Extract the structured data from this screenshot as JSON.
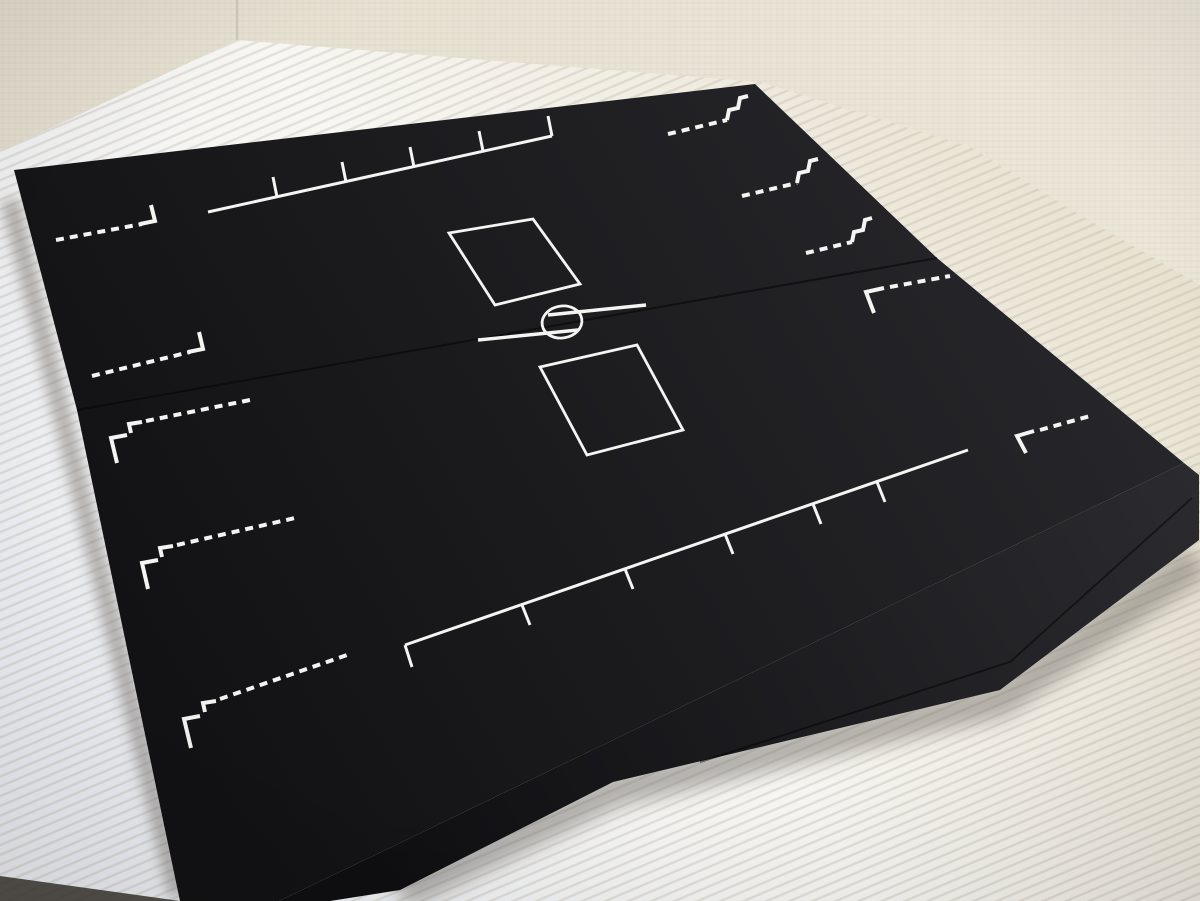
{
  "scene": {
    "description": "Photograph of a matte-black folding game board (duel-field style) with white printed zone markings, lying on a white corrugated plastic sheet in front of a cream textured wall",
    "objects": {
      "board": {
        "material": "matte black board, two hinged halves with visible center fold seam and edge thickness",
        "markings": {
          "top_ruler_ticks": 5,
          "bottom_ruler_ticks": 6,
          "card_zones": 2,
          "center_circle": 1,
          "offset_fold_lines": 2,
          "upper_left_dashed_corner_markers": 2,
          "upper_right_stepped_markers": 3,
          "right_dashed_corner_markers": 2,
          "lower_left_stepped_markers": 3
        }
      },
      "floor": "white corrugated plastic sheet with fine diagonal ridges, warm cream toward upper right",
      "wall": "cream woven-textured wallpaper with a corner seam at upper left"
    }
  },
  "colors": {
    "wall": "#ece7d9",
    "wall_left": "#e5dfd0",
    "wall_line": "#cfc9b8",
    "floor_white": "#f8f7f3",
    "floor_cream": "#e9e2d0",
    "floor_cool": "#edeff4",
    "board_light": "#26262a",
    "board_dark": "#121214",
    "side_light": "#2b2b2f",
    "side_dark": "#0f0f12",
    "marking": "#f4f4f2",
    "seam": "#070708",
    "shadow": "#6b6660",
    "floor_edge_dark": "#38342d"
  }
}
